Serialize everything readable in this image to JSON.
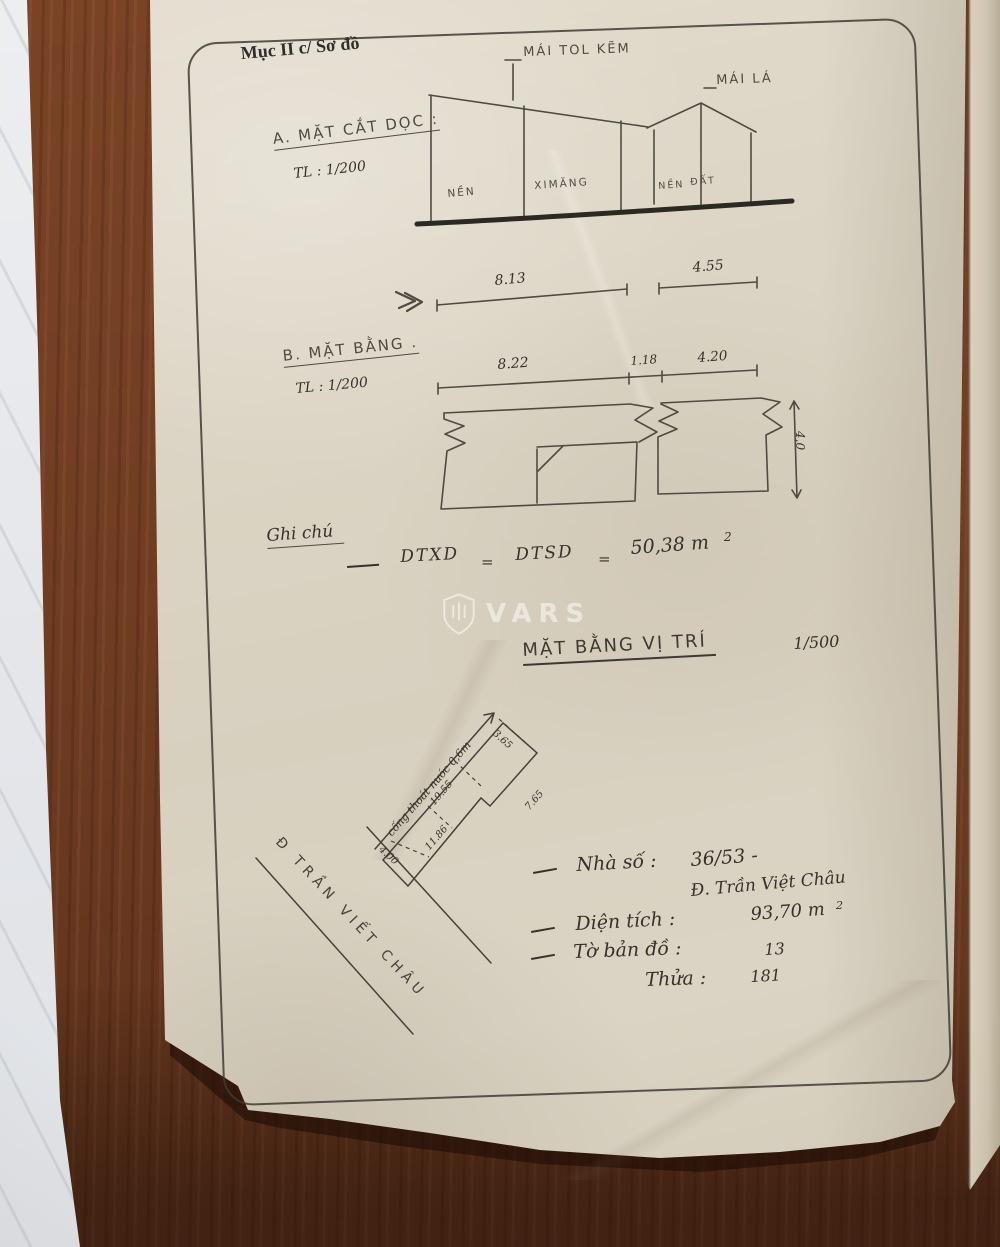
{
  "header": {
    "section_label": "Mục II c/ Sơ đồ"
  },
  "section_a": {
    "title": "A. MẶT CẮT DỌC :",
    "scale": "TL : 1/200",
    "roof_label_main": "MÁI TOL KẼM",
    "roof_label_small": "MÁI LÁ",
    "floor_labels": [
      "NỀN",
      "XIMĂNG",
      "NỀN",
      "ĐẤT"
    ],
    "dims": {
      "left": "8.13",
      "right": "4.55"
    }
  },
  "section_b": {
    "title": "B. MẶT BẰNG .",
    "scale": "TL : 1/200",
    "dims": {
      "d1": "8.22",
      "d2": "1.18",
      "d3": "4.20",
      "depth": "4.0"
    }
  },
  "notes_area": {
    "title": "Ghi chú",
    "formula": {
      "lhs": "DTXD",
      "eq1": "=",
      "mid": "DTSD",
      "eq2": "=",
      "value": "50,38 m",
      "sup": "2"
    }
  },
  "watermark": {
    "brand": "VARS"
  },
  "site_plan": {
    "title": "MẶT BẰNG VỊ TRÍ",
    "scale": "1/500",
    "drain_label": "cống thoát nước 0,6m",
    "street_name": "Đ TRẦN VIẾT CHÂU",
    "dims": {
      "front": "4.00",
      "side_lower": "11.86",
      "side_upper": "19.55",
      "end": "3.65",
      "side_far": "7.65"
    }
  },
  "property_notes": {
    "line1_label": "Nhà số :",
    "line1_value": "36/53 -",
    "line2": "Đ. Trần Việt Châu",
    "line3_label": "Diện tích :",
    "line3_value": "93,70 m",
    "line3_sup": "2",
    "line4_label": "Tờ bản đồ :",
    "line4_value": "13",
    "line5_label": "Thửa :",
    "line5_value": "181"
  }
}
